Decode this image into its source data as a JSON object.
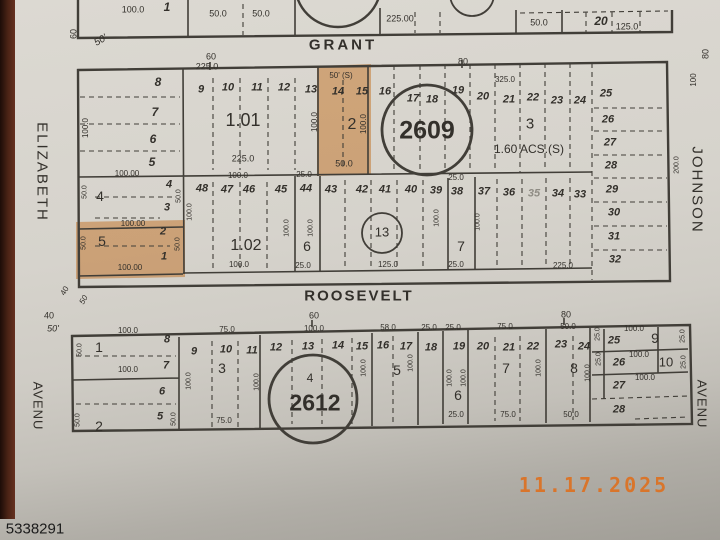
{
  "stamp": {
    "date": "11.17.2025",
    "id": "5338291",
    "date_color": "#d9752b"
  },
  "map": {
    "highlight_color": "#e8913e",
    "labels": [
      {
        "t": "100.0",
        "x": 133,
        "y": 10,
        "s": 9
      },
      {
        "t": "1",
        "x": 167,
        "y": 7,
        "s": 12,
        "f": "bi"
      },
      {
        "t": "50.0",
        "x": 218,
        "y": 14,
        "s": 9
      },
      {
        "t": "50.0",
        "x": 261,
        "y": 14,
        "s": 9
      },
      {
        "t": "225.00",
        "x": 400,
        "y": 19,
        "s": 9
      },
      {
        "t": "50.0",
        "x": 539,
        "y": 23,
        "s": 9
      },
      {
        "t": "20",
        "x": 601,
        "y": 21,
        "s": 12,
        "f": "bi"
      },
      {
        "t": "125.0",
        "x": 627,
        "y": 27,
        "s": 9
      },
      {
        "t": "60",
        "x": 74,
        "y": 34,
        "s": 9,
        "r": -90
      },
      {
        "t": "50'",
        "x": 101,
        "y": 41,
        "s": 10,
        "f": "i",
        "r": -30
      },
      {
        "t": "GRANT",
        "x": 343,
        "y": 45,
        "s": 15,
        "f": "b",
        "ls": 3,
        "n": "street-grant"
      },
      {
        "t": "60",
        "x": 211,
        "y": 57,
        "s": 9
      },
      {
        "t": "80",
        "x": 463,
        "y": 62,
        "s": 9
      },
      {
        "t": "80",
        "x": 706,
        "y": 54,
        "s": 9,
        "r": -90
      },
      {
        "t": "100",
        "x": 694,
        "y": 80,
        "s": 8,
        "r": -90
      },
      {
        "t": "8",
        "x": 158,
        "y": 82,
        "s": 12,
        "f": "bi"
      },
      {
        "t": "7",
        "x": 155,
        "y": 112,
        "s": 12,
        "f": "bi"
      },
      {
        "t": "6",
        "x": 153,
        "y": 139,
        "s": 12,
        "f": "bi"
      },
      {
        "t": "5",
        "x": 152,
        "y": 162,
        "s": 12,
        "f": "bi"
      },
      {
        "t": "100.0",
        "x": 86,
        "y": 128,
        "s": 8,
        "r": -90
      },
      {
        "t": "225.0",
        "x": 207,
        "y": 67,
        "s": 9
      },
      {
        "t": "9",
        "x": 201,
        "y": 90,
        "s": 11,
        "f": "bi"
      },
      {
        "t": "10",
        "x": 228,
        "y": 88,
        "s": 11,
        "f": "bi"
      },
      {
        "t": "11",
        "x": 257,
        "y": 88,
        "s": 11,
        "f": "bi"
      },
      {
        "t": "12",
        "x": 284,
        "y": 88,
        "s": 11,
        "f": "bi"
      },
      {
        "t": "13",
        "x": 311,
        "y": 90,
        "s": 11,
        "f": "bi"
      },
      {
        "t": "1.01",
        "x": 243,
        "y": 120,
        "s": 18,
        "n": "parcel-1-01"
      },
      {
        "t": "225.0",
        "x": 243,
        "y": 159,
        "s": 9
      },
      {
        "t": "100.0",
        "x": 315,
        "y": 122,
        "s": 8,
        "r": -90
      },
      {
        "t": "50' (S)",
        "x": 341,
        "y": 76,
        "s": 8
      },
      {
        "t": "14",
        "x": 338,
        "y": 92,
        "s": 11,
        "f": "bi"
      },
      {
        "t": "15",
        "x": 362,
        "y": 92,
        "s": 11,
        "f": "bi"
      },
      {
        "t": "2",
        "x": 352,
        "y": 125,
        "s": 16,
        "n": "parcel-2"
      },
      {
        "t": "100.0",
        "x": 364,
        "y": 124,
        "s": 8,
        "r": -90
      },
      {
        "t": "50.0",
        "x": 344,
        "y": 164,
        "s": 9
      },
      {
        "t": "16",
        "x": 385,
        "y": 92,
        "s": 11,
        "f": "bi"
      },
      {
        "t": "17",
        "x": 413,
        "y": 99,
        "s": 11,
        "f": "bi"
      },
      {
        "t": "18",
        "x": 432,
        "y": 100,
        "s": 11,
        "f": "bi"
      },
      {
        "t": "19",
        "x": 458,
        "y": 91,
        "s": 11,
        "f": "bi"
      },
      {
        "t": "2609",
        "x": 427,
        "y": 131,
        "s": 25,
        "f": "b",
        "n": "block-number-2609"
      },
      {
        "t": "20",
        "x": 483,
        "y": 97,
        "s": 11,
        "f": "bi"
      },
      {
        "t": "21",
        "x": 509,
        "y": 100,
        "s": 11,
        "f": "bi"
      },
      {
        "t": "22",
        "x": 533,
        "y": 98,
        "s": 11,
        "f": "bi"
      },
      {
        "t": "23",
        "x": 557,
        "y": 101,
        "s": 11,
        "f": "bi"
      },
      {
        "t": "24",
        "x": 580,
        "y": 101,
        "s": 11,
        "f": "bi"
      },
      {
        "t": "25",
        "x": 606,
        "y": 94,
        "s": 11,
        "f": "bi"
      },
      {
        "t": "325.0",
        "x": 505,
        "y": 80,
        "s": 8
      },
      {
        "t": "3",
        "x": 530,
        "y": 124,
        "s": 15,
        "n": "parcel-3"
      },
      {
        "t": "1.60 ACS.(S)",
        "x": 529,
        "y": 149,
        "s": 12,
        "n": "parcel-3-area"
      },
      {
        "t": "26",
        "x": 608,
        "y": 120,
        "s": 11,
        "f": "bi"
      },
      {
        "t": "27",
        "x": 610,
        "y": 143,
        "s": 11,
        "f": "bi"
      },
      {
        "t": "28",
        "x": 611,
        "y": 166,
        "s": 11,
        "f": "bi"
      },
      {
        "t": "29",
        "x": 612,
        "y": 190,
        "s": 11,
        "f": "bi"
      },
      {
        "t": "30",
        "x": 614,
        "y": 213,
        "s": 11,
        "f": "bi"
      },
      {
        "t": "31",
        "x": 614,
        "y": 237,
        "s": 11,
        "f": "bi"
      },
      {
        "t": "32",
        "x": 615,
        "y": 260,
        "s": 11,
        "f": "bi"
      },
      {
        "t": "200.0",
        "x": 677,
        "y": 165,
        "s": 7,
        "r": -90
      },
      {
        "t": "100.00",
        "x": 127,
        "y": 174,
        "s": 8
      },
      {
        "t": "4",
        "x": 100,
        "y": 196,
        "s": 14,
        "n": "parcel-4"
      },
      {
        "t": "4",
        "x": 169,
        "y": 185,
        "s": 11,
        "f": "bi"
      },
      {
        "t": "3",
        "x": 167,
        "y": 208,
        "s": 11,
        "f": "bi"
      },
      {
        "t": "50.0",
        "x": 85,
        "y": 192,
        "s": 7,
        "r": -90
      },
      {
        "t": "50.0",
        "x": 179,
        "y": 196,
        "s": 7,
        "r": -90
      },
      {
        "t": "100.00",
        "x": 133,
        "y": 224,
        "s": 8
      },
      {
        "t": "5",
        "x": 102,
        "y": 241,
        "s": 14,
        "n": "parcel-5"
      },
      {
        "t": "2",
        "x": 163,
        "y": 232,
        "s": 11,
        "f": "bi"
      },
      {
        "t": "1",
        "x": 164,
        "y": 257,
        "s": 11,
        "f": "bi"
      },
      {
        "t": "50.0",
        "x": 84,
        "y": 243,
        "s": 7,
        "r": -90
      },
      {
        "t": "50.0",
        "x": 178,
        "y": 244,
        "s": 7,
        "r": -90
      },
      {
        "t": "100.00",
        "x": 130,
        "y": 268,
        "s": 8
      },
      {
        "t": "100.0",
        "x": 238,
        "y": 176,
        "s": 8
      },
      {
        "t": "48",
        "x": 202,
        "y": 189,
        "s": 11,
        "f": "bi"
      },
      {
        "t": "47",
        "x": 227,
        "y": 190,
        "s": 11,
        "f": "bi"
      },
      {
        "t": "46",
        "x": 249,
        "y": 190,
        "s": 11,
        "f": "bi"
      },
      {
        "t": "45",
        "x": 281,
        "y": 190,
        "s": 11,
        "f": "bi"
      },
      {
        "t": "100.0",
        "x": 190,
        "y": 212,
        "s": 7,
        "r": -90
      },
      {
        "t": "1.02",
        "x": 246,
        "y": 246,
        "s": 16,
        "n": "parcel-1-02"
      },
      {
        "t": "100.0",
        "x": 239,
        "y": 265,
        "s": 8
      },
      {
        "t": "25.0",
        "x": 304,
        "y": 175,
        "s": 8
      },
      {
        "t": "44",
        "x": 306,
        "y": 189,
        "s": 11,
        "f": "bi"
      },
      {
        "t": "100.0",
        "x": 287,
        "y": 228,
        "s": 7,
        "r": -90
      },
      {
        "t": "100.0",
        "x": 311,
        "y": 228,
        "s": 7,
        "r": -90
      },
      {
        "t": "6",
        "x": 307,
        "y": 246,
        "s": 14,
        "n": "parcel-6"
      },
      {
        "t": "25.0",
        "x": 303,
        "y": 266,
        "s": 8
      },
      {
        "t": "43",
        "x": 331,
        "y": 190,
        "s": 11,
        "f": "bi"
      },
      {
        "t": "42",
        "x": 362,
        "y": 190,
        "s": 11,
        "f": "bi"
      },
      {
        "t": "41",
        "x": 385,
        "y": 190,
        "s": 11,
        "f": "bi"
      },
      {
        "t": "40",
        "x": 411,
        "y": 190,
        "s": 11,
        "f": "bi"
      },
      {
        "t": "39",
        "x": 436,
        "y": 191,
        "s": 11,
        "f": "bi"
      },
      {
        "t": "13",
        "x": 382,
        "y": 232,
        "s": 13,
        "n": "lot-circle-13"
      },
      {
        "t": "100.0",
        "x": 437,
        "y": 218,
        "s": 7,
        "r": -90
      },
      {
        "t": "125.0",
        "x": 388,
        "y": 265,
        "s": 8
      },
      {
        "t": "38",
        "x": 457,
        "y": 192,
        "s": 11,
        "f": "bi"
      },
      {
        "t": "25.0",
        "x": 456,
        "y": 178,
        "s": 8
      },
      {
        "t": "7",
        "x": 461,
        "y": 246,
        "s": 14,
        "n": "parcel-7"
      },
      {
        "t": "25.0",
        "x": 456,
        "y": 265,
        "s": 8
      },
      {
        "t": "100.0",
        "x": 478,
        "y": 222,
        "s": 7,
        "r": -90
      },
      {
        "t": "37",
        "x": 484,
        "y": 192,
        "s": 11,
        "f": "bi"
      },
      {
        "t": "36",
        "x": 509,
        "y": 193,
        "s": 11,
        "f": "bi"
      },
      {
        "t": "35",
        "x": 534,
        "y": 194,
        "s": 11,
        "f": "bi",
        "c": "#8f8c84"
      },
      {
        "t": "34",
        "x": 558,
        "y": 194,
        "s": 11,
        "f": "bi"
      },
      {
        "t": "33",
        "x": 580,
        "y": 195,
        "s": 11,
        "f": "bi"
      },
      {
        "t": "225.0",
        "x": 563,
        "y": 266,
        "s": 8
      },
      {
        "t": "40",
        "x": 65,
        "y": 291,
        "s": 8,
        "r": -60
      },
      {
        "t": "50",
        "x": 84,
        "y": 300,
        "s": 8,
        "r": -60,
        "f": "i"
      },
      {
        "t": "40",
        "x": 49,
        "y": 316,
        "s": 9
      },
      {
        "t": "50'",
        "x": 53,
        "y": 329,
        "s": 9,
        "f": "i"
      },
      {
        "t": "ROOSEVELT",
        "x": 359,
        "y": 296,
        "s": 15,
        "f": "b",
        "ls": 2,
        "n": "street-roosevelt"
      },
      {
        "t": "60",
        "x": 314,
        "y": 316,
        "s": 9
      },
      {
        "t": "80",
        "x": 566,
        "y": 315,
        "s": 9
      },
      {
        "t": "100.0",
        "x": 128,
        "y": 331,
        "s": 8
      },
      {
        "t": "8",
        "x": 167,
        "y": 340,
        "s": 11,
        "f": "bi"
      },
      {
        "t": "1",
        "x": 99,
        "y": 347,
        "s": 14,
        "n": "parcel-2612-1"
      },
      {
        "t": "50.0",
        "x": 80,
        "y": 350,
        "s": 7,
        "r": -90
      },
      {
        "t": "100.0",
        "x": 128,
        "y": 370,
        "s": 8
      },
      {
        "t": "7",
        "x": 166,
        "y": 366,
        "s": 11,
        "f": "bi"
      },
      {
        "t": "6",
        "x": 162,
        "y": 392,
        "s": 11,
        "f": "bi"
      },
      {
        "t": "5",
        "x": 160,
        "y": 417,
        "s": 11,
        "f": "bi"
      },
      {
        "t": "2",
        "x": 99,
        "y": 426,
        "s": 14,
        "n": "parcel-2612-2"
      },
      {
        "t": "50.0",
        "x": 78,
        "y": 420,
        "s": 7,
        "r": -90
      },
      {
        "t": "50.0",
        "x": 174,
        "y": 419,
        "s": 7,
        "r": -90
      },
      {
        "t": "75.0",
        "x": 227,
        "y": 330,
        "s": 8
      },
      {
        "t": "9",
        "x": 194,
        "y": 352,
        "s": 11,
        "f": "bi"
      },
      {
        "t": "10",
        "x": 226,
        "y": 350,
        "s": 11,
        "f": "bi"
      },
      {
        "t": "11",
        "x": 252,
        "y": 351,
        "s": 11,
        "f": "bi"
      },
      {
        "t": "3",
        "x": 222,
        "y": 368,
        "s": 14,
        "n": "parcel-2612-3"
      },
      {
        "t": "100.0",
        "x": 189,
        "y": 381,
        "s": 7,
        "r": -90
      },
      {
        "t": "100.0",
        "x": 257,
        "y": 382,
        "s": 7,
        "r": -90
      },
      {
        "t": "75.0",
        "x": 224,
        "y": 421,
        "s": 8
      },
      {
        "t": "100.0",
        "x": 314,
        "y": 329,
        "s": 8
      },
      {
        "t": "12",
        "x": 276,
        "y": 348,
        "s": 11,
        "f": "bi"
      },
      {
        "t": "13",
        "x": 308,
        "y": 347,
        "s": 11,
        "f": "bi"
      },
      {
        "t": "14",
        "x": 338,
        "y": 346,
        "s": 11,
        "f": "bi"
      },
      {
        "t": "15",
        "x": 362,
        "y": 347,
        "s": 11,
        "f": "bi"
      },
      {
        "t": "4",
        "x": 310,
        "y": 378,
        "s": 12,
        "n": "parcel-2612-4"
      },
      {
        "t": "2612",
        "x": 315,
        "y": 403,
        "s": 23,
        "f": "b",
        "n": "block-number-2612"
      },
      {
        "t": "100.0",
        "x": 364,
        "y": 368,
        "s": 7,
        "r": -90
      },
      {
        "t": "58.0",
        "x": 388,
        "y": 328,
        "s": 8
      },
      {
        "t": "16",
        "x": 383,
        "y": 346,
        "s": 11,
        "f": "bi"
      },
      {
        "t": "17",
        "x": 406,
        "y": 347,
        "s": 11,
        "f": "bi"
      },
      {
        "t": "5",
        "x": 397,
        "y": 370,
        "s": 14,
        "n": "parcel-2612-5"
      },
      {
        "t": "100.0",
        "x": 411,
        "y": 363,
        "s": 7,
        "r": -90
      },
      {
        "t": "25.0",
        "x": 429,
        "y": 328,
        "s": 8
      },
      {
        "t": "18",
        "x": 431,
        "y": 348,
        "s": 11,
        "f": "bi"
      },
      {
        "t": "25.0",
        "x": 453,
        "y": 328,
        "s": 8
      },
      {
        "t": "19",
        "x": 459,
        "y": 347,
        "s": 11,
        "f": "bi"
      },
      {
        "t": "100.0",
        "x": 450,
        "y": 378,
        "s": 7,
        "r": -90
      },
      {
        "t": "100.0",
        "x": 464,
        "y": 378,
        "s": 7,
        "r": -90
      },
      {
        "t": "6",
        "x": 458,
        "y": 395,
        "s": 14,
        "n": "parcel-2612-6"
      },
      {
        "t": "25.0",
        "x": 456,
        "y": 415,
        "s": 8
      },
      {
        "t": "75.0",
        "x": 505,
        "y": 327,
        "s": 8
      },
      {
        "t": "20",
        "x": 483,
        "y": 347,
        "s": 11,
        "f": "bi"
      },
      {
        "t": "21",
        "x": 509,
        "y": 348,
        "s": 11,
        "f": "bi"
      },
      {
        "t": "22",
        "x": 533,
        "y": 347,
        "s": 11,
        "f": "bi"
      },
      {
        "t": "7",
        "x": 506,
        "y": 368,
        "s": 14,
        "n": "parcel-2612-7"
      },
      {
        "t": "100.0",
        "x": 539,
        "y": 368,
        "s": 7,
        "r": -90
      },
      {
        "t": "75.0",
        "x": 508,
        "y": 415,
        "s": 8
      },
      {
        "t": "50.0",
        "x": 568,
        "y": 327,
        "s": 8
      },
      {
        "t": "23",
        "x": 561,
        "y": 345,
        "s": 11,
        "f": "bi"
      },
      {
        "t": "24",
        "x": 584,
        "y": 347,
        "s": 11,
        "f": "bi"
      },
      {
        "t": "8",
        "x": 574,
        "y": 368,
        "s": 14,
        "n": "parcel-2612-8"
      },
      {
        "t": "100.0",
        "x": 588,
        "y": 373,
        "s": 7,
        "r": -90
      },
      {
        "t": "50.0",
        "x": 571,
        "y": 415,
        "s": 8
      },
      {
        "t": "25.0",
        "x": 598,
        "y": 334,
        "s": 7,
        "r": -90
      },
      {
        "t": "100.0",
        "x": 634,
        "y": 329,
        "s": 8
      },
      {
        "t": "25",
        "x": 614,
        "y": 341,
        "s": 11,
        "f": "bi"
      },
      {
        "t": "9",
        "x": 655,
        "y": 338,
        "s": 14,
        "n": "parcel-2612-9"
      },
      {
        "t": "25.0",
        "x": 683,
        "y": 336,
        "s": 7,
        "r": -90
      },
      {
        "t": "25.0",
        "x": 599,
        "y": 359,
        "s": 7,
        "r": -90
      },
      {
        "t": "26",
        "x": 619,
        "y": 363,
        "s": 11,
        "f": "bi"
      },
      {
        "t": "100.0",
        "x": 639,
        "y": 355,
        "s": 8
      },
      {
        "t": "10",
        "x": 666,
        "y": 362,
        "s": 13,
        "n": "parcel-2612-10"
      },
      {
        "t": "25.0",
        "x": 684,
        "y": 362,
        "s": 7,
        "r": -90
      },
      {
        "t": "27",
        "x": 619,
        "y": 386,
        "s": 11,
        "f": "bi"
      },
      {
        "t": "100.0",
        "x": 645,
        "y": 378,
        "s": 8
      },
      {
        "t": "28",
        "x": 619,
        "y": 410,
        "s": 11,
        "f": "bi"
      },
      {
        "t": "ELIZABETH",
        "x": 42,
        "y": 172,
        "s": 15,
        "r": 90,
        "ls": 2,
        "n": "street-elizabeth"
      },
      {
        "t": "AVENU",
        "x": 38,
        "y": 406,
        "s": 13,
        "r": 90,
        "ls": 1,
        "n": "street-avenue-left"
      },
      {
        "t": "JOHNSON",
        "x": 697,
        "y": 190,
        "s": 15,
        "r": 90,
        "ls": 2,
        "n": "street-johnson"
      },
      {
        "t": "AVENU",
        "x": 702,
        "y": 404,
        "s": 13,
        "r": 90,
        "ls": 1,
        "n": "street-avenue-right"
      }
    ]
  }
}
